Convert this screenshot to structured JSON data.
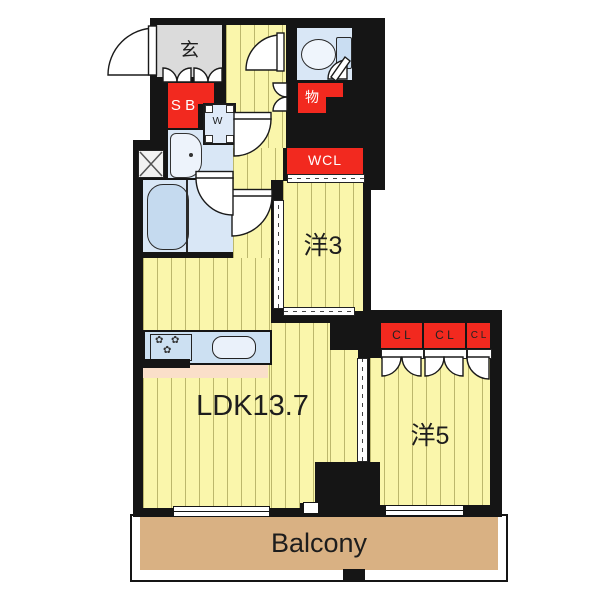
{
  "rooms": {
    "genkan": "玄",
    "shoe_box": "S B",
    "washer": "W",
    "storage": "物",
    "walk_in_closet": "WCL",
    "western_room_3": "洋3",
    "western_room_5": "洋5",
    "ldk": "LDK13.7",
    "balcony": "Balcony"
  },
  "closets": [
    "C L",
    "C L",
    "C L"
  ],
  "fixtures": [
    "entrance-door",
    "toilet",
    "bathtub",
    "washbasin",
    "washing-machine",
    "pipe-shaft",
    "kitchen-stove",
    "kitchen-sink"
  ],
  "colors": {
    "wall": "#151515",
    "floor_yellow": "#faf6ab",
    "floor_stripe": "#bcb76c",
    "wet_area_blue": "#d9e7f6",
    "accent_red": "#f2291f",
    "genkan_gray": "#dbdbdb",
    "balcony_tan": "#d9b183",
    "kitchen_peach": "#fadfc9"
  }
}
